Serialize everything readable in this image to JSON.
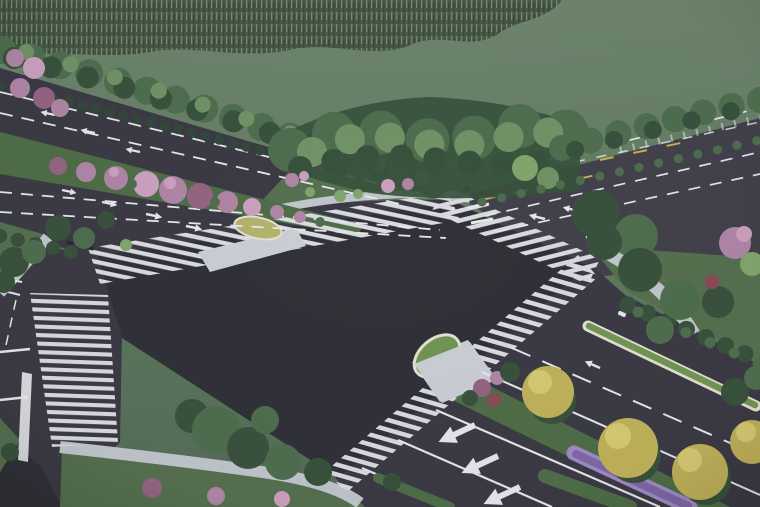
{
  "meta": {
    "image_type": "photographed architectural rendering",
    "subject": "aerial bird's-eye view of a landscaped four-way road intersection",
    "visible_text": "none"
  },
  "palette": {
    "field_top": "#6d8369",
    "field_low": "#55705578",
    "field_base": "#5d785c",
    "forest": "#43553f",
    "asphalt_road": "#36343d",
    "asphalt_far": "#3d3b44",
    "asphalt_center": "#2a2930",
    "corner_grass": "#516c49",
    "median_green": "#4a6a40",
    "tree_dark": "#324c35",
    "tree_mid": "#4a6a48",
    "tree_light": "#6e9161",
    "tree_bright": "#7fa566",
    "shrub_dark": "#2c4133",
    "pink": "#b183a4",
    "pink_light": "#cf9fc0",
    "pink_deep": "#93607f",
    "yellow_tree": "#c3b254",
    "yellow_light": "#d9cc6e",
    "red_bush": "#8a4450",
    "white_mark": "#e9eaee",
    "zebra": "#dcdde2",
    "sidewalk": "#c2c7cd",
    "apron": "#ccd0d6",
    "island_fill": "#b5b366",
    "island_rim": "#e7e4d2",
    "dome_green": "#6f934e",
    "purple": "#7e63a6",
    "purple_light": "#a289c6",
    "lane_yellow": "#c6b24c",
    "car_dark": "#23242a",
    "car_white": "#e8eaec"
  },
  "scene": {
    "regions": [
      "grass field with forest treeline at top",
      "northwest boulevard with pink flowering median",
      "east road with tree median and yellow lane lines",
      "southwest road with painted median island",
      "southeast boulevard with yellow ginkgo trees and purple flower bed",
      "central asphalt intersection with four zebra crosswalks",
      "corner lawns with curved sidewalks and ornamental trees",
      "pedestrian refuge islands with grass domes"
    ]
  }
}
